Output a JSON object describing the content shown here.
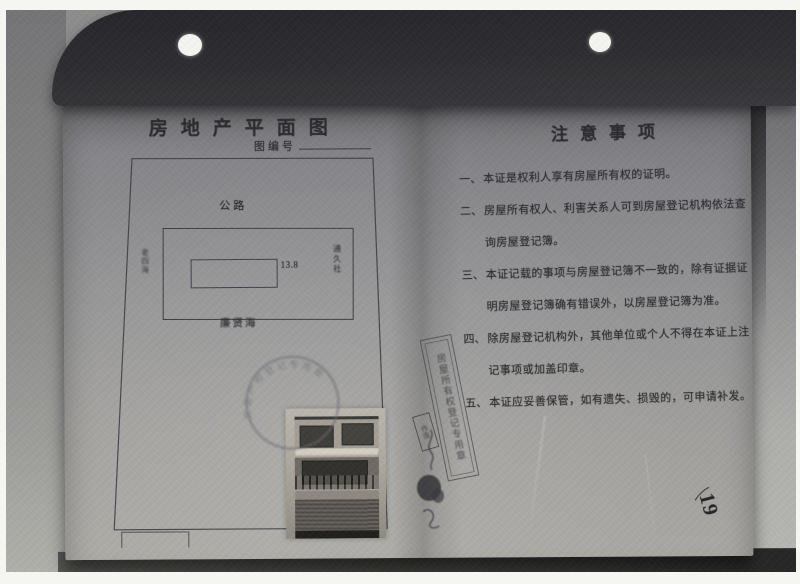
{
  "document": {
    "left_page": {
      "title": "房地产平面图",
      "drawing_no_label": "图编号",
      "plan": {
        "north_label": "公路",
        "south_label": "廉贤海",
        "east_label": "通久社",
        "west_label": "老四海",
        "width_dimension": "13.8"
      }
    },
    "right_page": {
      "title": "注意事项",
      "items": [
        {
          "no": "一、",
          "lines": [
            "本证是权利人享有房屋所有权的证明。"
          ]
        },
        {
          "no": "二、",
          "lines": [
            "房屋所有权人、利害关系人可到房屋登记机构依法查",
            "询房屋登记簿。"
          ]
        },
        {
          "no": "三、",
          "lines": [
            "本证记载的事项与房屋登记簿不一致的，除有证据证",
            "明房屋登记簿确有错误外，以房屋登记簿为准。"
          ]
        },
        {
          "no": "四、",
          "lines": [
            "除房屋登记机构外，其他单位或个人不得在本证上注",
            "记事项或加盖印章。"
          ]
        },
        {
          "no": "五、",
          "lines": [
            "本证应妥善保管，如有遗失、损毁的，可申请补发。"
          ]
        }
      ]
    },
    "page_number": "19",
    "stamps": {
      "round_seal_text": "房屋产权登记专用章",
      "strip_seal_text": "房屋所有权登记专用章",
      "small_seal_text": "作废"
    },
    "colors": {
      "paper_top": "#747478",
      "paper_bottom": "#abaaa5",
      "cover_dark": "#26262a",
      "ink": "#2c2c30"
    }
  }
}
